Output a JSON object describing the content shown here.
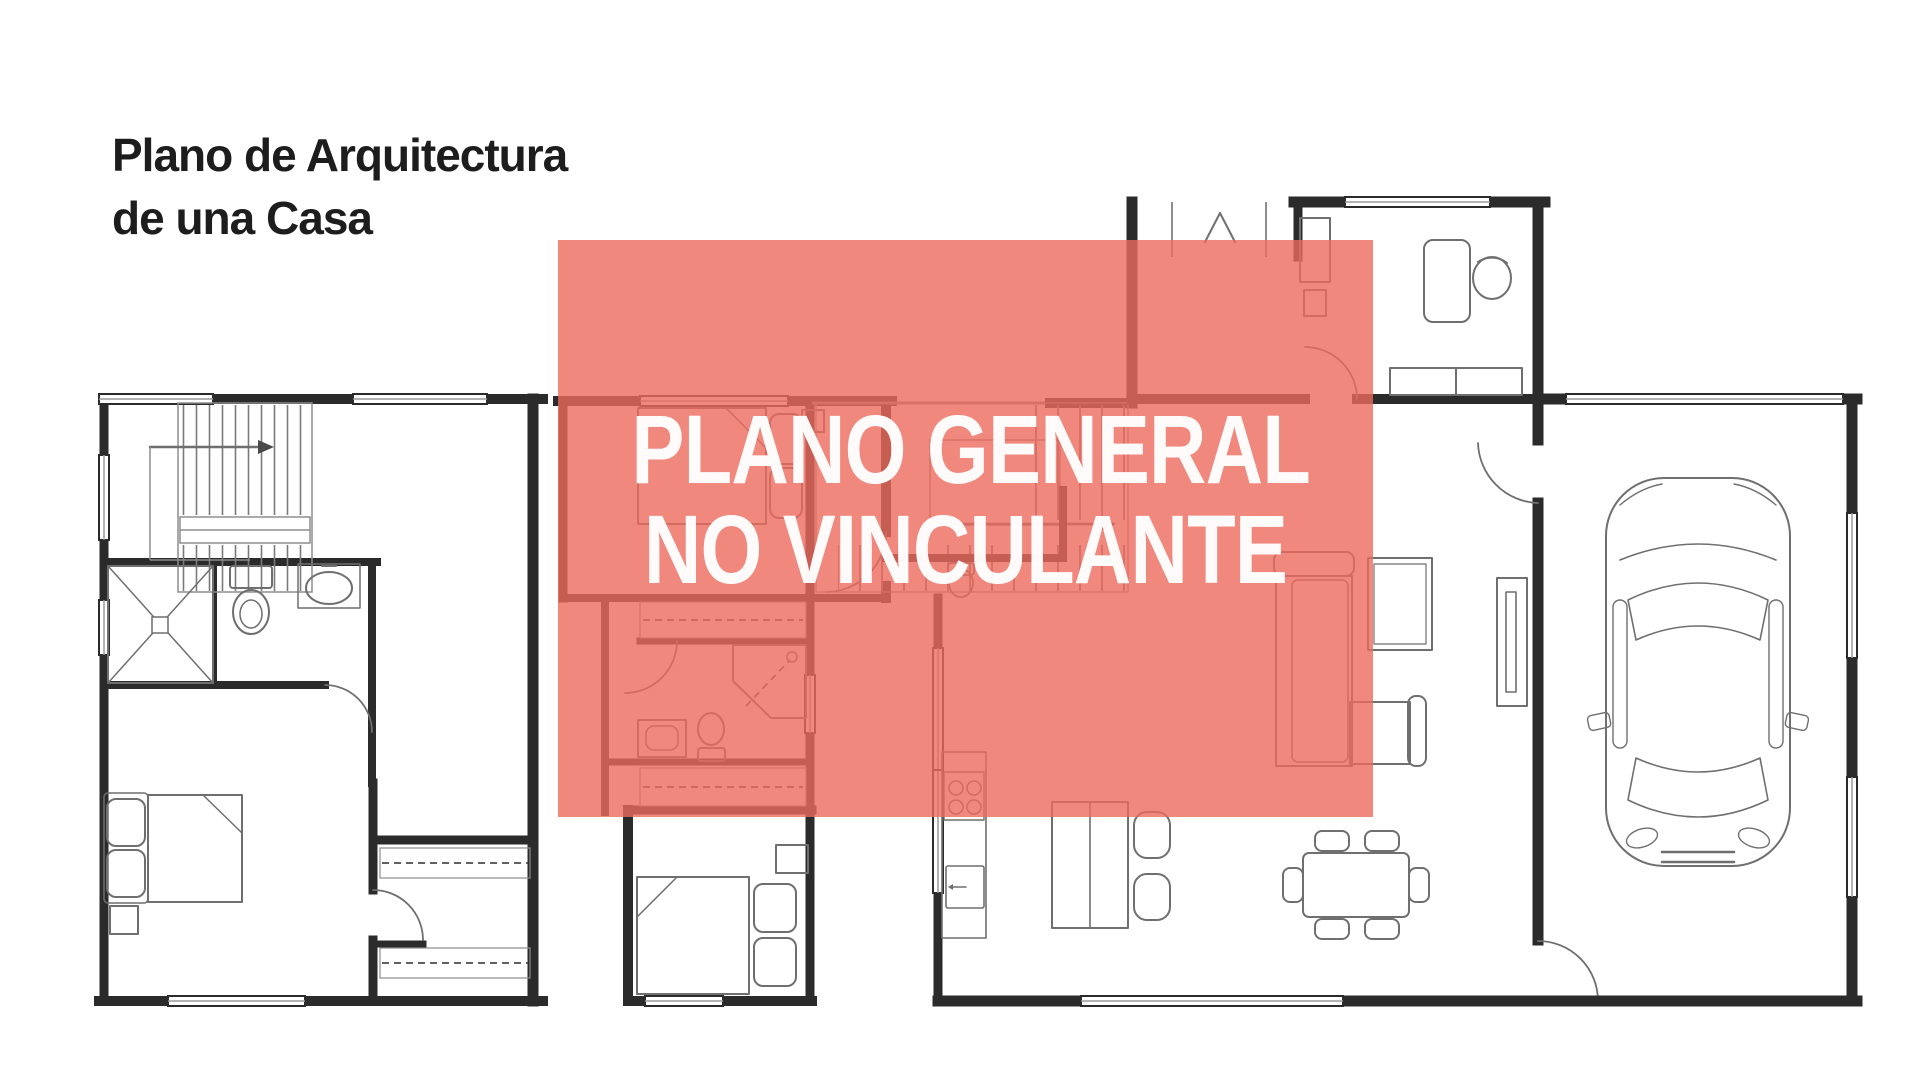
{
  "title": {
    "line1": "Plano de Arquitectura",
    "line2": "de una Casa"
  },
  "watermark": {
    "line1": "PLANO GENERAL",
    "line2": "NO VINCULANTE"
  },
  "colors": {
    "bg": "#ffffff",
    "ink": "#1d1d1d",
    "wall": "#2b2b2b",
    "furniture": "#6f6f6f",
    "overlay": "#ec6a5e",
    "overlay-text": "#ffffff"
  }
}
